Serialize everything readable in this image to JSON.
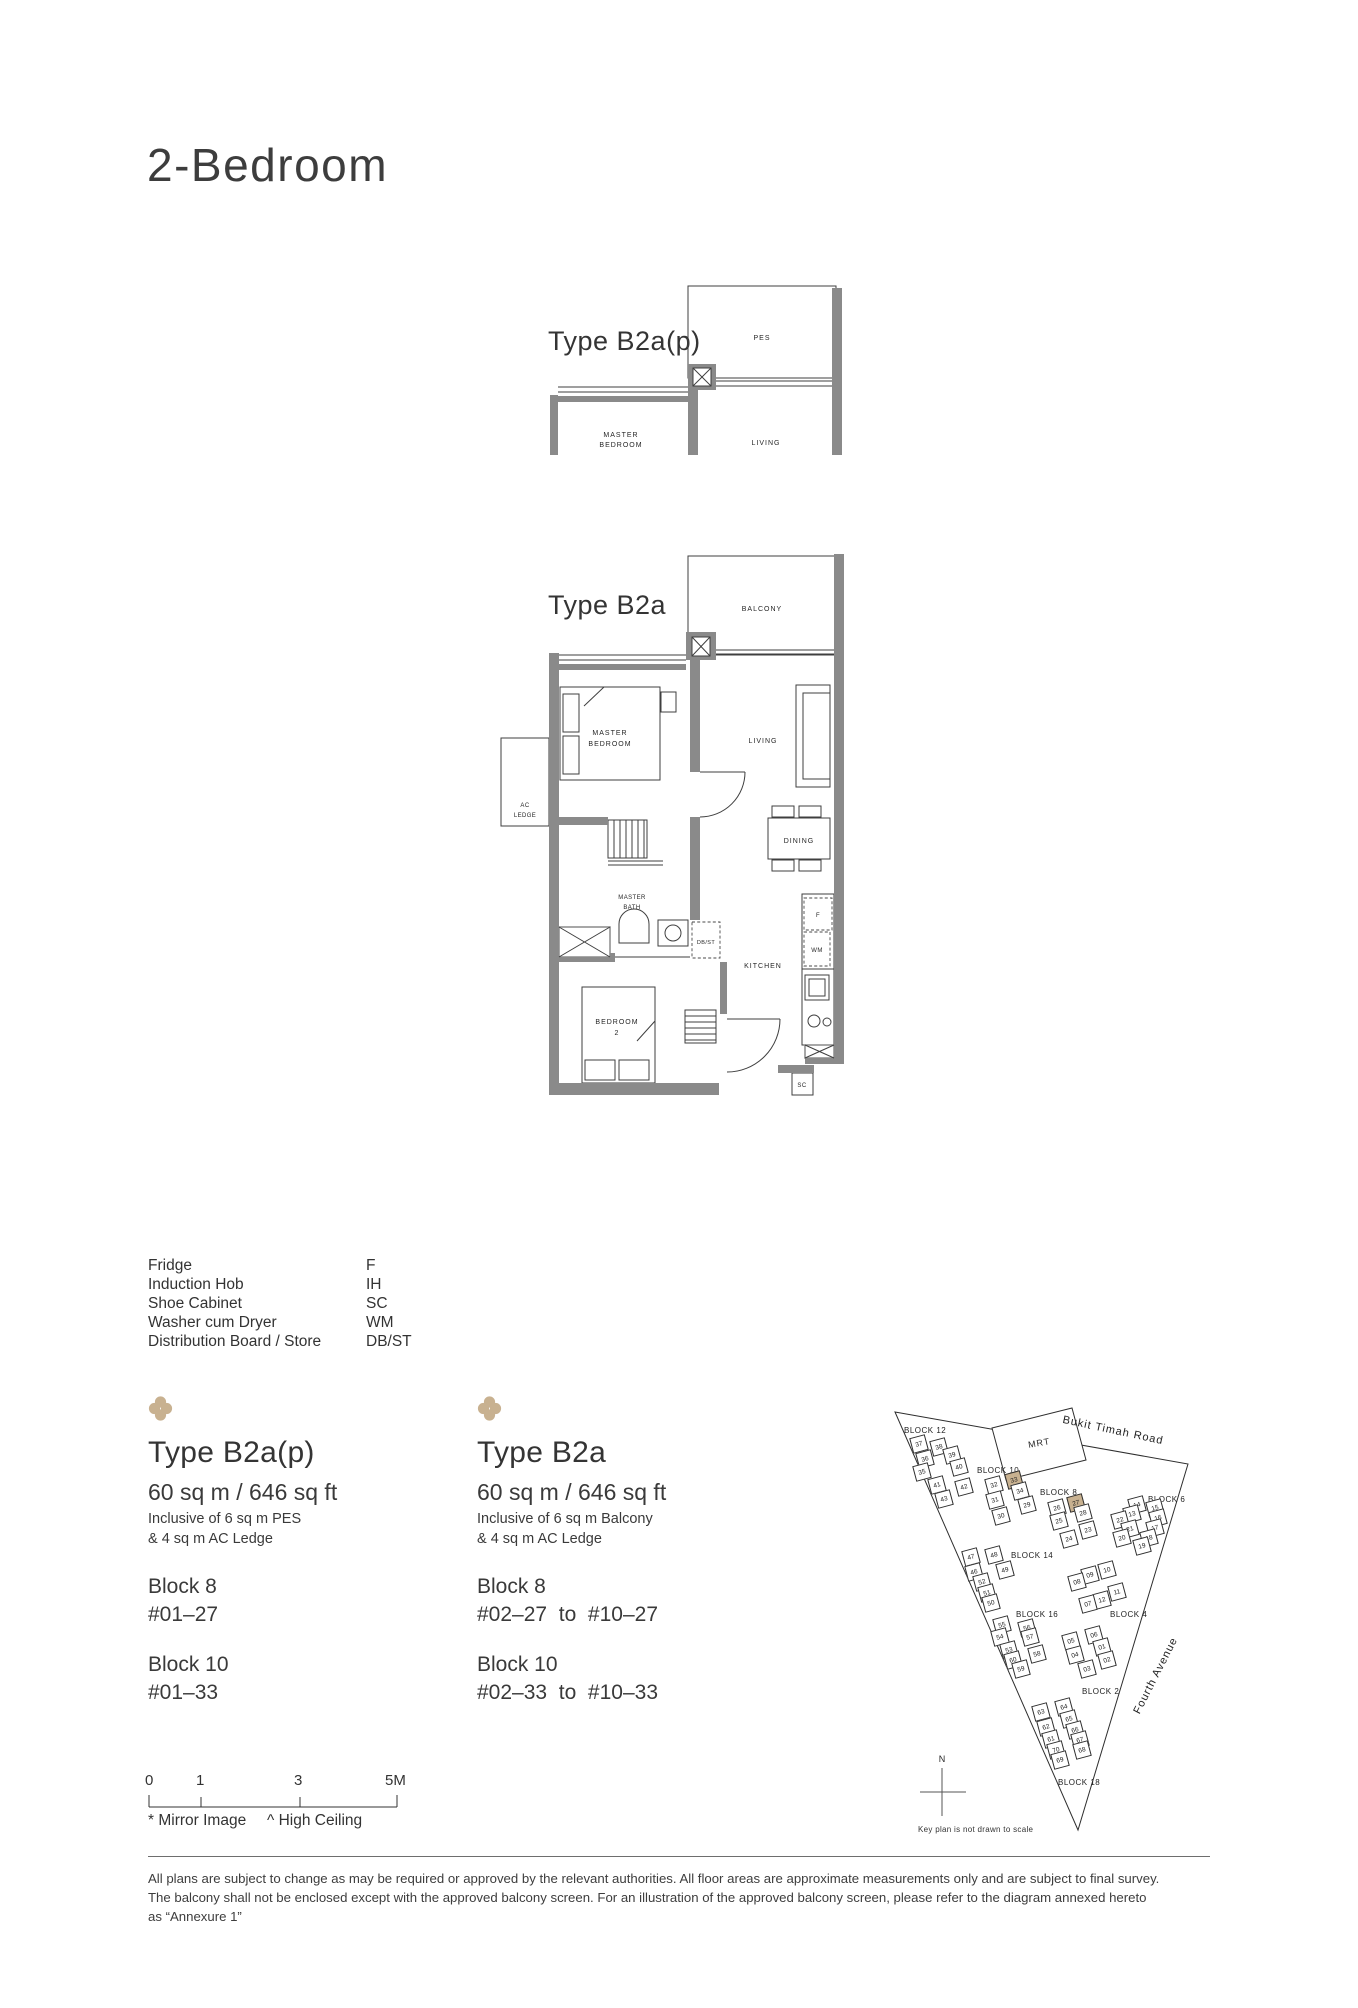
{
  "colors": {
    "accent": "#c8b190",
    "wall": "#8a8a8a"
  },
  "page": {
    "title": "2-Bedroom"
  },
  "plans": {
    "b2ap": {
      "title": "Type B2a(p)",
      "labels": {
        "pes": "PES",
        "master_1": "MASTER",
        "master_2": "BEDROOM",
        "living": "LIVING"
      }
    },
    "b2a": {
      "title": "Type B2a",
      "labels": {
        "balcony": "BALCONY",
        "master_1": "MASTER",
        "master_2": "BEDROOM",
        "living": "LIVING",
        "dining": "DINING",
        "kitchen": "KITCHEN",
        "bath_1": "MASTER",
        "bath_2": "BATH",
        "bed2_1": "BEDROOM",
        "bed2_2": "2",
        "ac_1": "AC",
        "ac_2": "LEDGE",
        "dbst": "DB/ST",
        "fridge": "F",
        "washer": "WM",
        "shoe_cabinet": "SC"
      }
    }
  },
  "legend": {
    "items": [
      {
        "name": "Fridge",
        "code": "F"
      },
      {
        "name": "Induction Hob",
        "code": "IH"
      },
      {
        "name": "Shoe Cabinet",
        "code": "SC"
      },
      {
        "name": "Washer cum Dryer",
        "code": "WM"
      },
      {
        "name": "Distribution Board / Store",
        "code": "DB/ST"
      }
    ]
  },
  "unit_types": [
    {
      "name": "Type B2a(p)",
      "area": "60 sq m / 646 sq ft",
      "inclusive_line1": "Inclusive of 6 sq m PES",
      "inclusive_line2": "& 4 sq m AC Ledge",
      "blocks": [
        {
          "name": "Block 8",
          "units": "#01–27"
        },
        {
          "name": "Block 10",
          "units": "#01–33"
        }
      ]
    },
    {
      "name": "Type B2a",
      "area": "60 sq m / 646 sq ft",
      "inclusive_line1": "Inclusive of 6 sq m Balcony",
      "inclusive_line2": "& 4 sq m AC Ledge",
      "blocks": [
        {
          "name": "Block 8",
          "units": "#02–27  to  #10–27"
        },
        {
          "name": "Block 10",
          "units": "#02–33  to  #10–33"
        }
      ]
    }
  ],
  "keyplan": {
    "road_top": "Bukit Timah Road",
    "road_right": "Fourth Avenue",
    "mrt_label": "MRT",
    "north_label": "N",
    "caption": "Key plan is not drawn to scale",
    "blocks": [
      {
        "label": "BLOCK 12",
        "lx": 12,
        "ly": 24,
        "units": [
          {
            "n": "37",
            "x": 27,
            "y": 42
          },
          {
            "n": "38",
            "x": 47,
            "y": 45
          },
          {
            "n": "36",
            "x": 33,
            "y": 57
          },
          {
            "n": "39",
            "x": 60,
            "y": 53
          },
          {
            "n": "35",
            "x": 30,
            "y": 70
          },
          {
            "n": "40",
            "x": 67,
            "y": 65
          },
          {
            "n": "41",
            "x": 45,
            "y": 83
          },
          {
            "n": "42",
            "x": 72,
            "y": 85
          },
          {
            "n": "43",
            "x": 52,
            "y": 97
          }
        ]
      },
      {
        "label": "BLOCK 10",
        "lx": 85,
        "ly": 64,
        "units": [
          {
            "n": "32",
            "x": 102,
            "y": 83
          },
          {
            "n": "33",
            "x": 122,
            "y": 78,
            "hl": true
          },
          {
            "n": "34",
            "x": 128,
            "y": 89
          },
          {
            "n": "31",
            "x": 103,
            "y": 98
          },
          {
            "n": "29",
            "x": 135,
            "y": 103
          },
          {
            "n": "30",
            "x": 109,
            "y": 114
          }
        ]
      },
      {
        "label": "BLOCK 8",
        "lx": 148,
        "ly": 86,
        "units": [
          {
            "n": "26",
            "x": 165,
            "y": 106
          },
          {
            "n": "27",
            "x": 184,
            "y": 101,
            "hl": true
          },
          {
            "n": "28",
            "x": 191,
            "y": 111
          },
          {
            "n": "25",
            "x": 167,
            "y": 119
          },
          {
            "n": "23",
            "x": 196,
            "y": 128
          },
          {
            "n": "24",
            "x": 177,
            "y": 137
          }
        ]
      },
      {
        "label": "BLOCK 6",
        "lx": 256,
        "ly": 93,
        "units": [
          {
            "n": "14",
            "x": 245,
            "y": 103
          },
          {
            "n": "15",
            "x": 263,
            "y": 106
          },
          {
            "n": "13",
            "x": 240,
            "y": 112
          },
          {
            "n": "16",
            "x": 266,
            "y": 116
          },
          {
            "n": "22",
            "x": 228,
            "y": 118
          },
          {
            "n": "17",
            "x": 263,
            "y": 126
          },
          {
            "n": "21",
            "x": 238,
            "y": 127
          },
          {
            "n": "18",
            "x": 257,
            "y": 136
          },
          {
            "n": "20",
            "x": 230,
            "y": 136
          },
          {
            "n": "19",
            "x": 250,
            "y": 144
          }
        ]
      },
      {
        "label": "BLOCK 14",
        "lx": 119,
        "ly": 149,
        "units": [
          {
            "n": "47",
            "x": 79,
            "y": 155
          },
          {
            "n": "48",
            "x": 102,
            "y": 153
          },
          {
            "n": "46",
            "x": 82,
            "y": 170
          },
          {
            "n": "49",
            "x": 113,
            "y": 168
          },
          {
            "n": "52",
            "x": 90,
            "y": 180
          },
          {
            "n": "51",
            "x": 95,
            "y": 191
          },
          {
            "n": "50",
            "x": 99,
            "y": 201
          }
        ]
      },
      {
        "label": "BLOCK 16",
        "lx": 124,
        "ly": 208,
        "units": [
          {
            "n": "55",
            "x": 110,
            "y": 223
          },
          {
            "n": "56",
            "x": 135,
            "y": 226
          },
          {
            "n": "54",
            "x": 108,
            "y": 235
          },
          {
            "n": "57",
            "x": 138,
            "y": 235
          },
          {
            "n": "53",
            "x": 117,
            "y": 248
          },
          {
            "n": "58",
            "x": 145,
            "y": 252
          },
          {
            "n": "60",
            "x": 121,
            "y": 258
          },
          {
            "n": "59",
            "x": 129,
            "y": 267
          }
        ]
      },
      {
        "label": "BLOCK 4",
        "lx": 218,
        "ly": 208,
        "units": [
          {
            "n": "10",
            "x": 215,
            "y": 168
          },
          {
            "n": "09",
            "x": 198,
            "y": 173
          },
          {
            "n": "08",
            "x": 185,
            "y": 180
          },
          {
            "n": "11",
            "x": 225,
            "y": 190
          },
          {
            "n": "12",
            "x": 210,
            "y": 198
          },
          {
            "n": "07",
            "x": 196,
            "y": 202
          },
          {
            "n": "06",
            "x": 202,
            "y": 233
          }
        ]
      },
      {
        "label": "BLOCK 2",
        "lx": 190,
        "ly": 285,
        "units": [
          {
            "n": "05",
            "x": 179,
            "y": 239
          },
          {
            "n": "01",
            "x": 210,
            "y": 245
          },
          {
            "n": "04",
            "x": 183,
            "y": 253
          },
          {
            "n": "02",
            "x": 215,
            "y": 258
          },
          {
            "n": "03",
            "x": 195,
            "y": 267
          }
        ]
      },
      {
        "label": "BLOCK 18",
        "lx": 166,
        "ly": 376,
        "units": [
          {
            "n": "64",
            "x": 172,
            "y": 305
          },
          {
            "n": "63",
            "x": 149,
            "y": 310
          },
          {
            "n": "65",
            "x": 177,
            "y": 317
          },
          {
            "n": "62",
            "x": 154,
            "y": 325
          },
          {
            "n": "66",
            "x": 183,
            "y": 328
          },
          {
            "n": "61",
            "x": 159,
            "y": 337
          },
          {
            "n": "67",
            "x": 188,
            "y": 338
          },
          {
            "n": "70",
            "x": 164,
            "y": 348
          },
          {
            "n": "68",
            "x": 190,
            "y": 348
          },
          {
            "n": "69",
            "x": 168,
            "y": 358
          }
        ]
      }
    ]
  },
  "scalebar": {
    "labels": [
      "0",
      "1",
      "3",
      "5M"
    ]
  },
  "footnotes": {
    "mirror_image": "* Mirror Image",
    "high_ceiling": "^ High Ceiling"
  },
  "disclaimer": {
    "line1": "All plans are subject to change as may be required or approved by the relevant authorities. All floor areas are approximate measurements only and are subject to final survey.",
    "line2": "The balcony shall not be enclosed except with the approved balcony screen. For an illustration of the approved balcony screen, please refer to the diagram annexed hereto",
    "line3": "as “Annexure 1”"
  }
}
